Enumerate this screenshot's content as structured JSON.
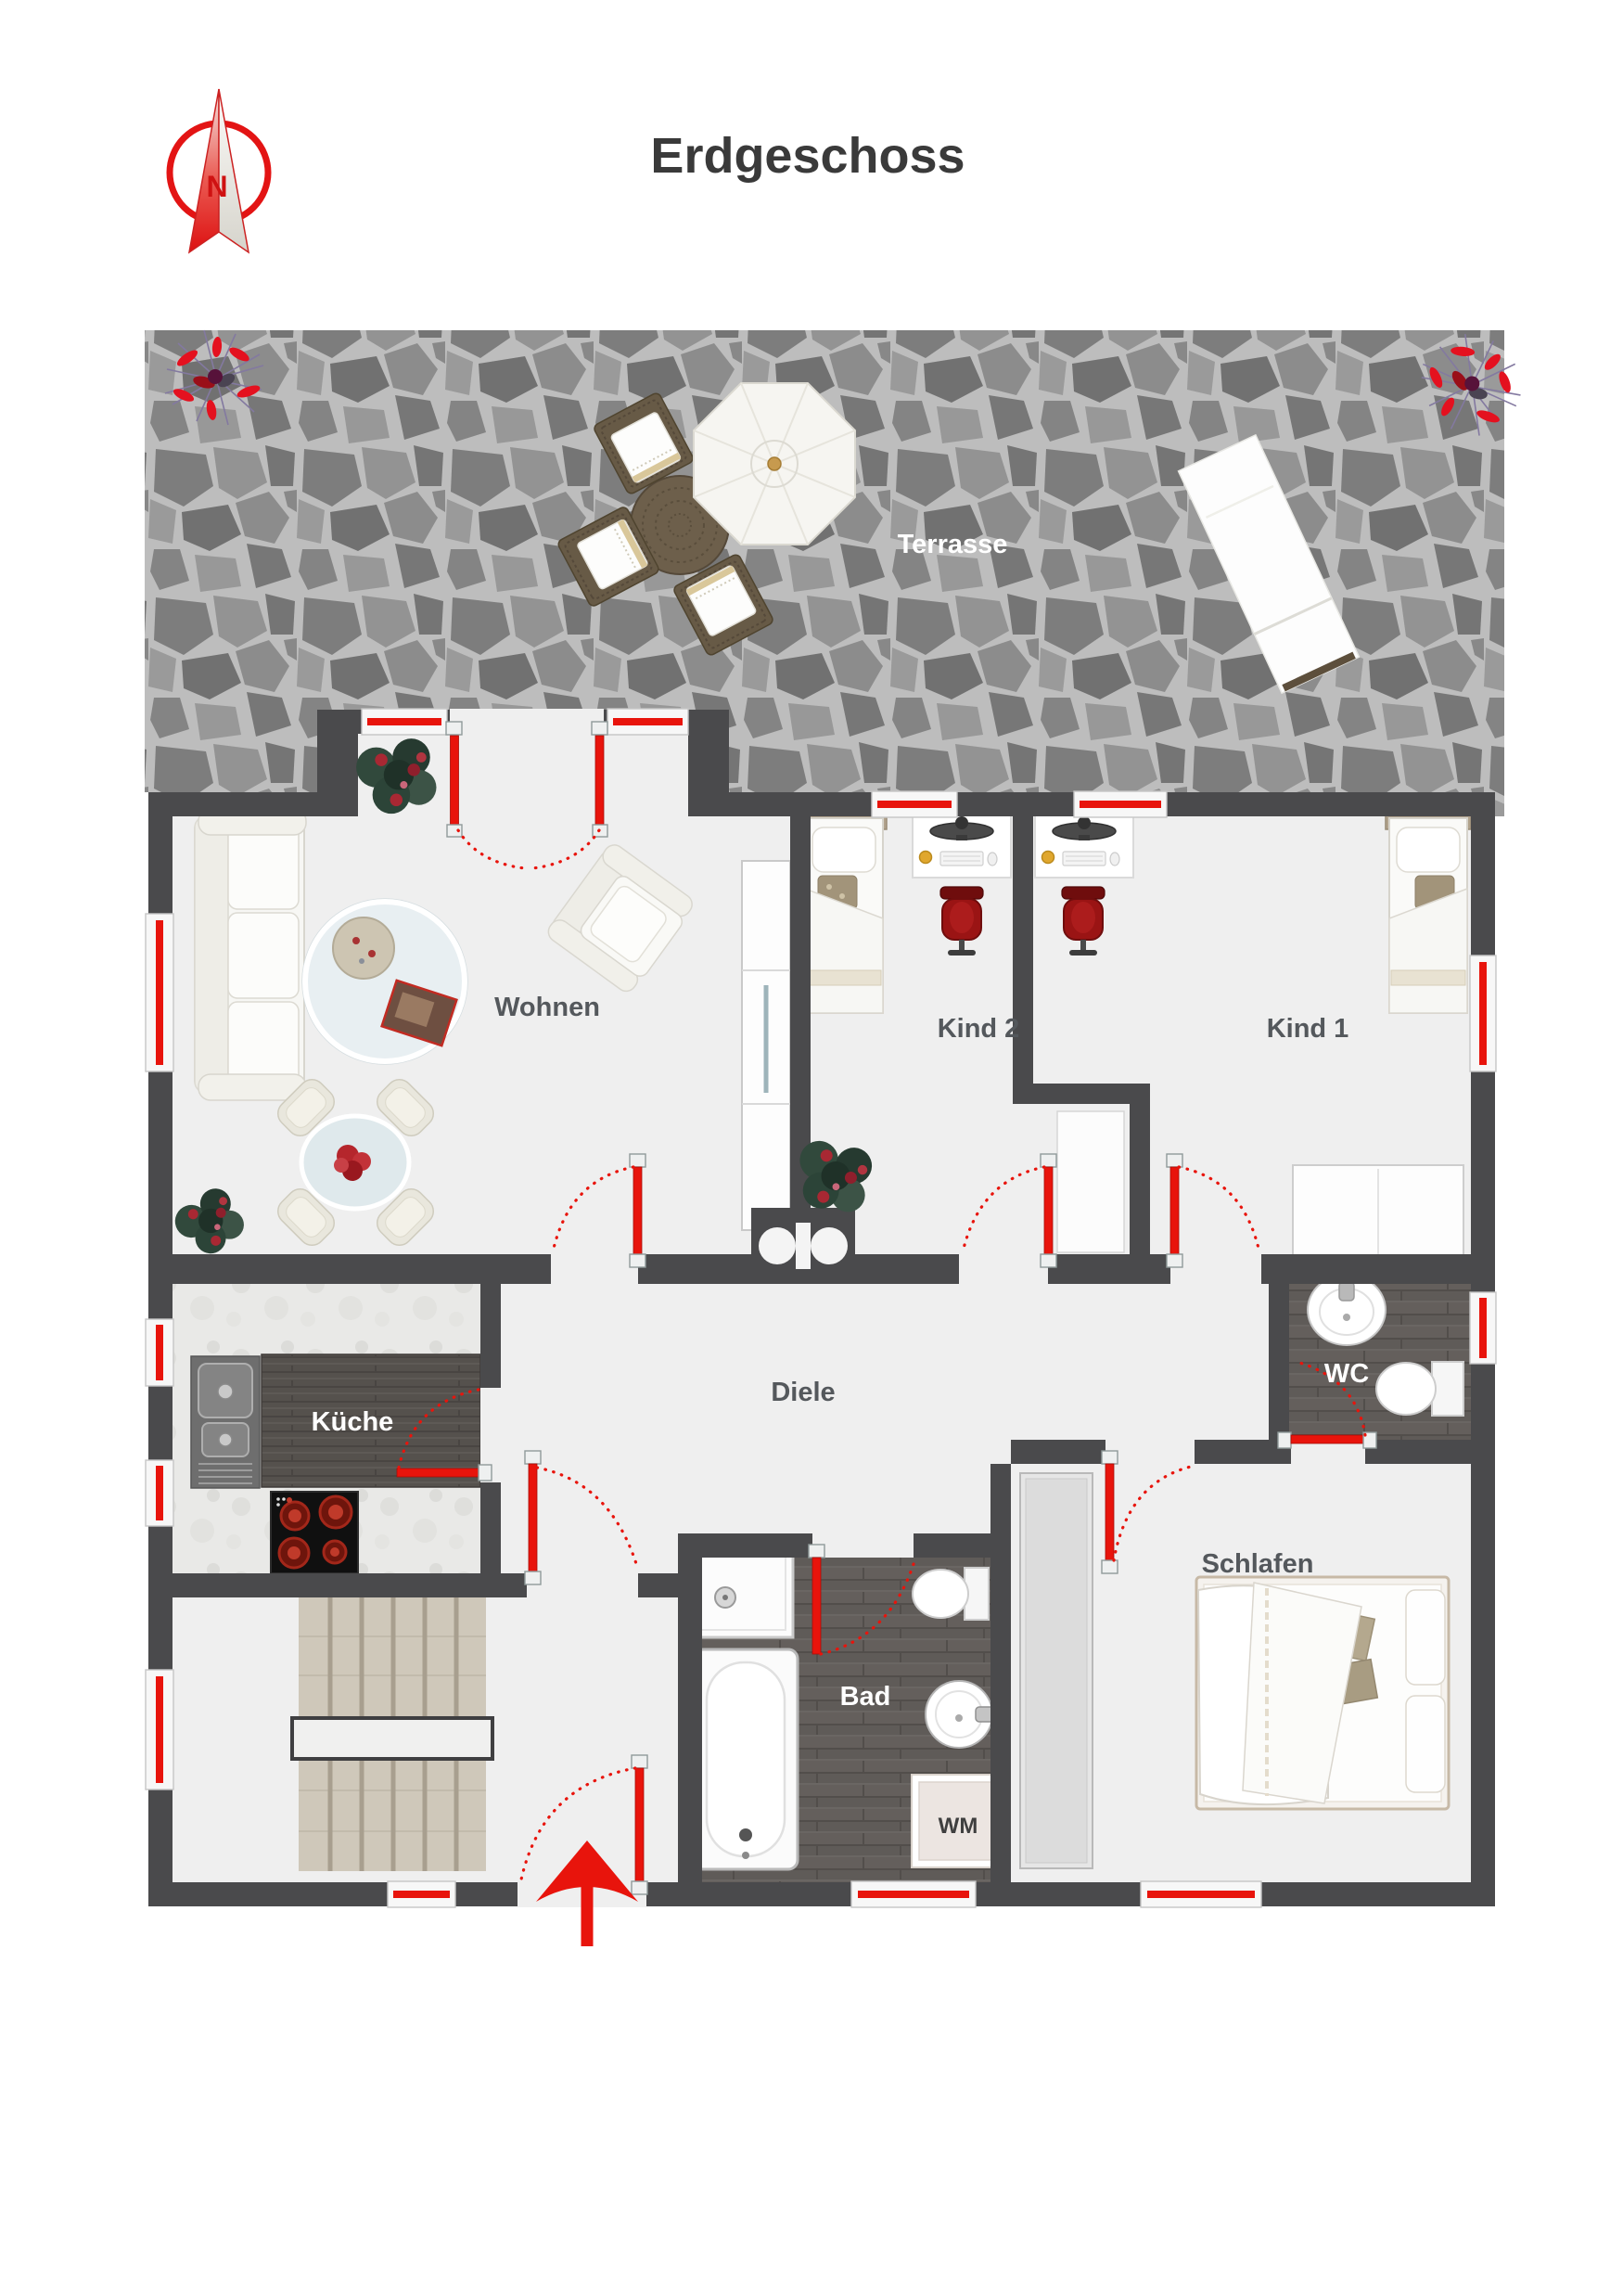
{
  "page": {
    "title": "Erdgeschoss"
  },
  "compass": {
    "north_label": "N"
  },
  "rooms": {
    "terrasse": "Terrasse",
    "wohnen": "Wohnen",
    "kind2": "Kind 2",
    "kind1": "Kind 1",
    "kueche": "Küche",
    "diele": "Diele",
    "wc": "WC",
    "bad": "Bad",
    "schlafen": "Schlafen"
  },
  "appliances": {
    "washing_machine": "WM"
  },
  "colors": {
    "accent_red": "#e8140c",
    "wall": "#4a4a4c",
    "floor": "#efefef",
    "label_dark": "#54585c",
    "label_light": "#ffffff",
    "title_text": "#3a3a3a",
    "terrace_stone": "#8a8a8a",
    "stone_grout": "#bdbdbd",
    "bath_floor_wood": "#5f5b58",
    "kitchen_counter_wood": "#55514d"
  }
}
